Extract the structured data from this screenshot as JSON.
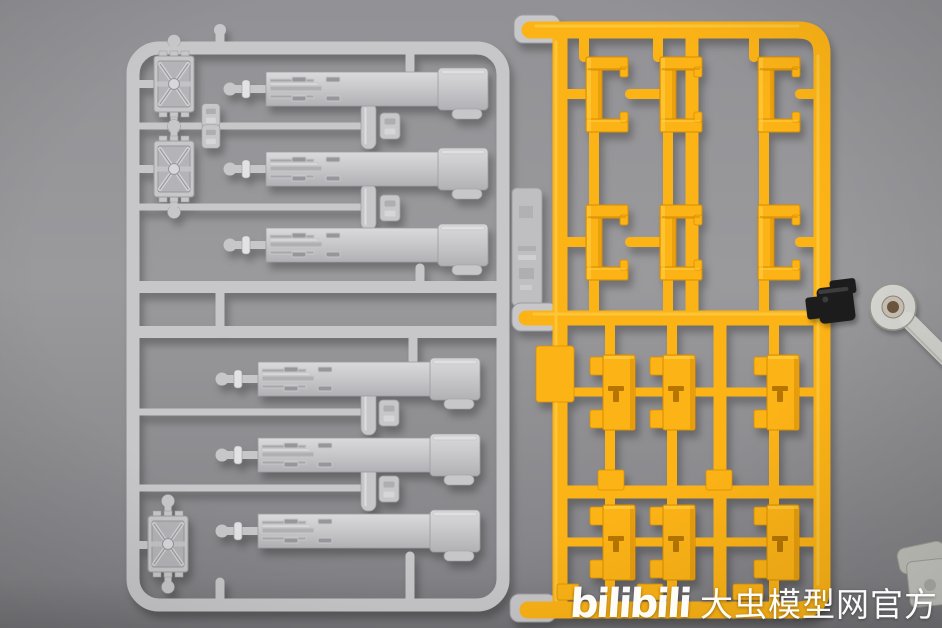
{
  "watermark": {
    "logo_text": "bilibili",
    "site_text": "大虫模型网官方",
    "color": "#ffffff"
  },
  "parts_visible": {
    "gray_sprue": {
      "grille_hatches": 3,
      "long_fender_blades": 6,
      "rod_parts": 4,
      "small_clips": 6,
      "molded_tag": 1
    },
    "yellow_sprue": {
      "c_brackets": 6,
      "flat_panels": 6,
      "blank_tab": 1,
      "gray_end_tabs": 3
    },
    "accessories": {
      "black_clamp": 1,
      "clear_stand_arm": 1,
      "clear_stand_base": 1
    }
  },
  "colors": {
    "bg_top": "#929296",
    "bg_mid": "#9a9a9d",
    "bg_bottom": "#848488",
    "gray_main": "#c7c7ca",
    "gray_light": "#e2e2e5",
    "gray_dark": "#9c9ca0",
    "gray_tag": "#bfbfc2",
    "yellow_main": "#fcb315",
    "yellow_light": "#ffd04a",
    "yellow_dark": "#d98e00",
    "yellow_deep": "#a86a00",
    "clamp_black": "#1b1b1d",
    "clear_plastic": "#dededa",
    "screw_brown": "#6e5640",
    "watermark": "#ffffff"
  }
}
